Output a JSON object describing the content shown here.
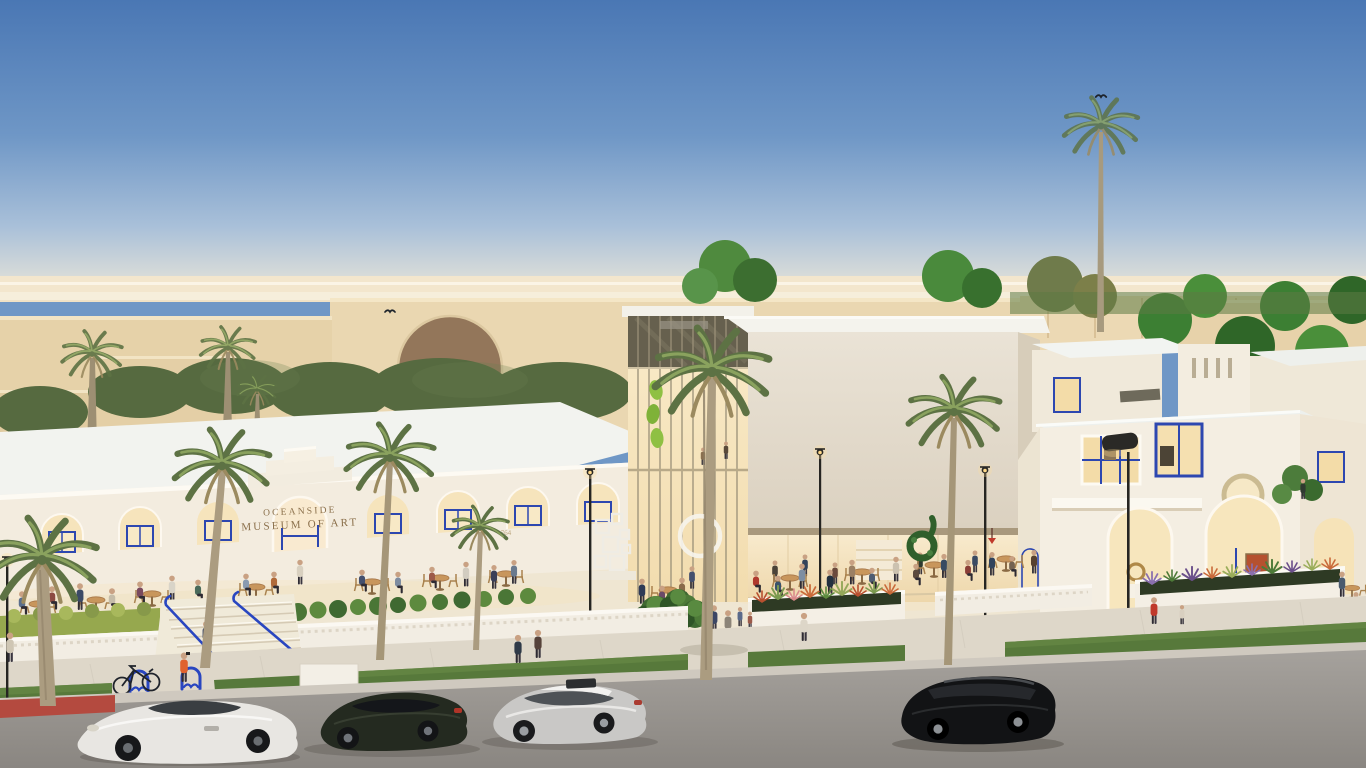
{
  "meta": {
    "scene_type": "architectural rendering",
    "description": "Dusk aerial street view of the Oceanside Museum of Art campus: white mission-style gallery buildings with blue-framed arched windows, elevated cream cube gallery with glass atrium, public plaza with cafe seating and crowds, palm trees, landscaped planters, and a street with four parked cars"
  },
  "signage": {
    "line1": "OCEANSIDE",
    "line2": "MUSEUM OF ART",
    "address_number": "764"
  },
  "palette": {
    "sky_top": "#4a77b4",
    "sky_mid": "#8fb0d3",
    "sky_horizon": "#f0e2c6",
    "horizon_band": "#f3e6cd",
    "bg_tan": "#ead7b1",
    "bg_tan_shadow": "#e0cba0",
    "roof_white": "#f2f3ef",
    "wall_cream": "#f3ecdf",
    "cube_face": "#e6dfd2",
    "interior_glow": "#f7e3ba",
    "accent_blue": "#2d47b0",
    "plaza_paving": "#efe6d2",
    "grass_green": "#57793b",
    "street_asphalt": "#9d9995",
    "curb_red": "#b44a3f",
    "palm_frond": "#6f8349",
    "palm_trunk": "#ab9c80",
    "tree_green": "#3c7f33",
    "lamp_black": "#2a2926",
    "glow_warm": "#ffd98a",
    "car_white_coupe": "#e8e6e2",
    "car_dark_sedan": "#242a20",
    "car_silver_sedan": "#c9c8c6",
    "car_black_suv": "#121315"
  },
  "inventory": {
    "buildings": [
      "left gallery wing with arched colonnade and museum sign",
      "glass atrium with leaf artwork",
      "elevated cube gallery with open ground floor",
      "right mission-style pavilion with round window and twin arches",
      "background tan complex with arched bridge"
    ],
    "vehicles": [
      "white sports coupe",
      "dark green sedan",
      "silver sedan",
      "black compact SUV"
    ],
    "street_furniture": [
      "blue bike racks",
      "bicycle",
      "blue stair railings",
      "street lamps",
      "white planter walls"
    ],
    "vegetation": [
      "palm trees",
      "hedge rows",
      "round shrubs",
      "planter grasses and flowers",
      "background tree canopies"
    ],
    "figures": "approximately sixty pedestrians and cafe patrons",
    "birds": 2,
    "art": [
      "white picture-frame installation",
      "white ring sculpture",
      "green loop topiary",
      "bronze loop sculpture",
      "bust on plinth"
    ]
  }
}
